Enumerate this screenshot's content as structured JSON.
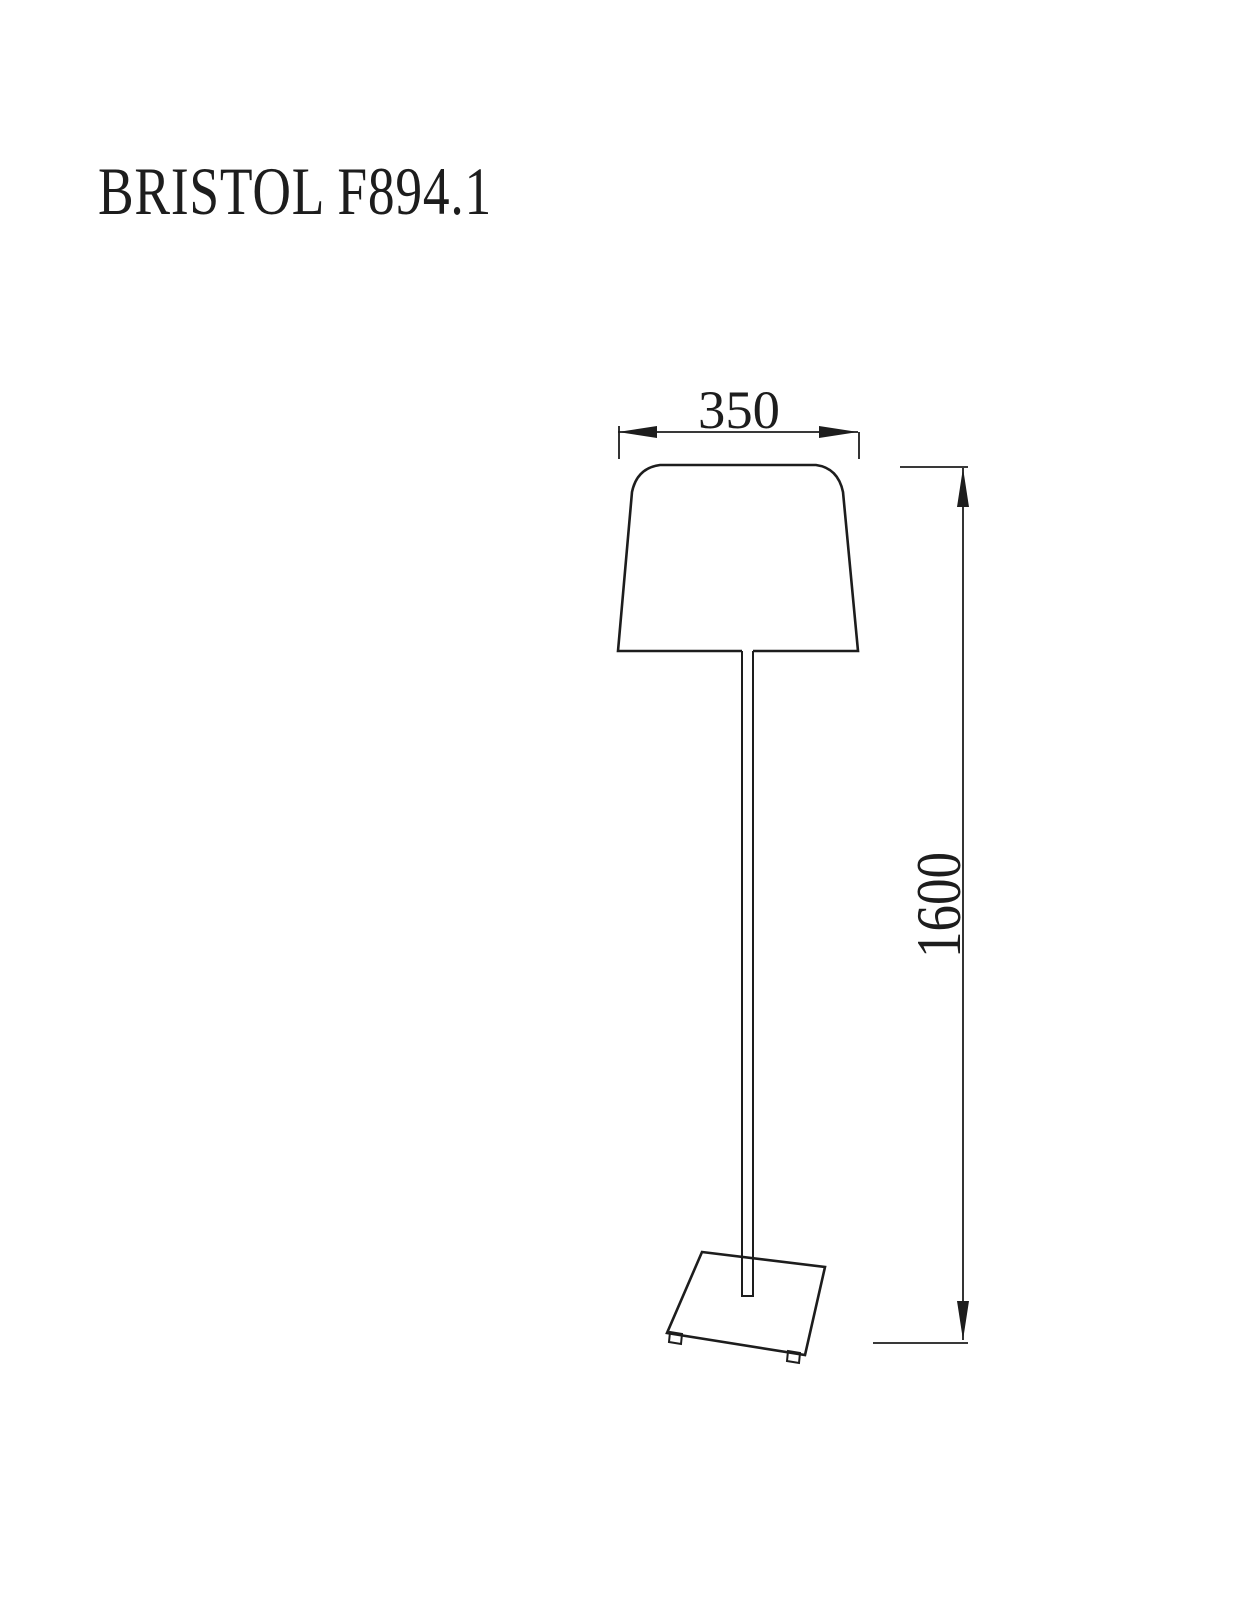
{
  "title": "BRISTOL F894.1",
  "drawing": {
    "object": "floor-lamp-technical-drawing",
    "parts": [
      "shade",
      "pole",
      "base",
      "feet"
    ],
    "dimension_width": {
      "label": "350",
      "orientation": "horizontal"
    },
    "dimension_height": {
      "label": "1600",
      "orientation": "vertical"
    }
  },
  "colors": {
    "background": "#ffffff",
    "line": "#1d1d1d"
  }
}
